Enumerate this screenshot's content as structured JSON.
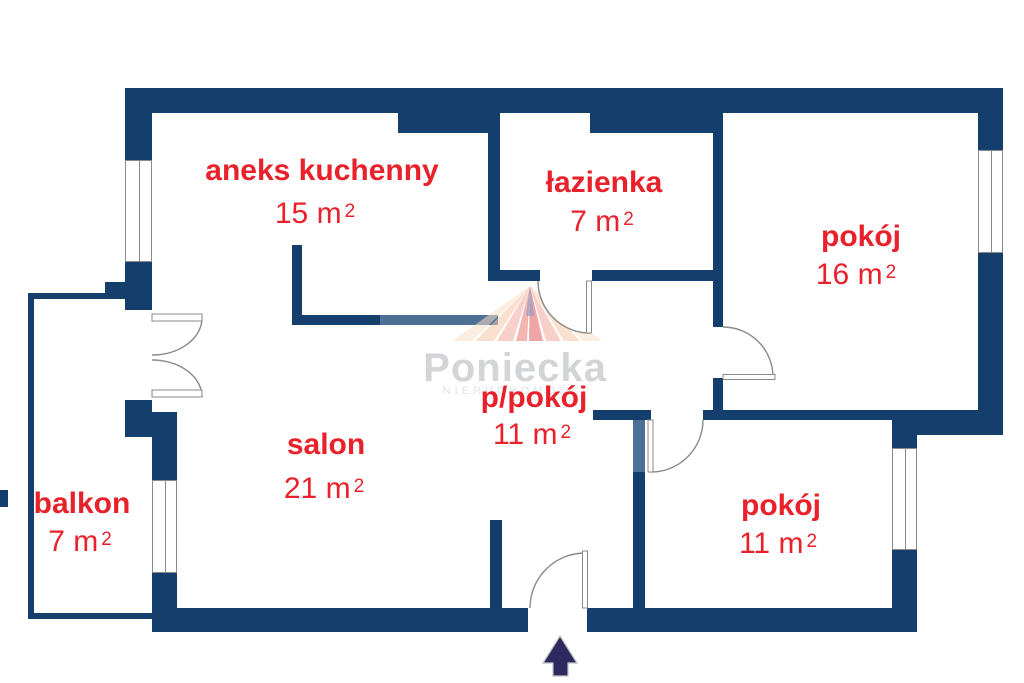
{
  "floorplan": {
    "type": "apartment floor plan",
    "watermark": {
      "brand": "Poniecka",
      "subtitle": "NIERUCHOMOŚCI"
    },
    "rooms": [
      {
        "id": "aneks-kuchenny",
        "name": "aneks kuchenny",
        "area": "15 m",
        "area_sup": "2"
      },
      {
        "id": "lazienka",
        "name": "łazienka",
        "area": "7 m",
        "area_sup": "2"
      },
      {
        "id": "pokoj-16",
        "name": "pokój",
        "area": "16 m",
        "area_sup": "2"
      },
      {
        "id": "p-pokoj",
        "name": "p/pokój",
        "area": "11 m",
        "area_sup": "2"
      },
      {
        "id": "salon",
        "name": "salon",
        "area": "21 m",
        "area_sup": "2"
      },
      {
        "id": "balkon",
        "name": "balkon",
        "area": "7 m",
        "area_sup": "2"
      },
      {
        "id": "pokoj-11",
        "name": "pokój",
        "area": "11 m",
        "area_sup": "2"
      }
    ],
    "entrance": {
      "direction": "up",
      "symbol": "entrance-arrow"
    },
    "colors": {
      "wall": "#143f6c",
      "wall_light": "#4d6f95",
      "label_red": "#e8212a",
      "arrow": "#2e2a60",
      "watermark_text": "#d2d4d7",
      "watermark_subtext": "#e0e2e5",
      "door_line": "#8a8a8a",
      "logo_fan": [
        "#f8dfc6",
        "#f6c7a8",
        "#f3ab9e",
        "#ea7a74",
        "#e25b5c"
      ]
    }
  }
}
